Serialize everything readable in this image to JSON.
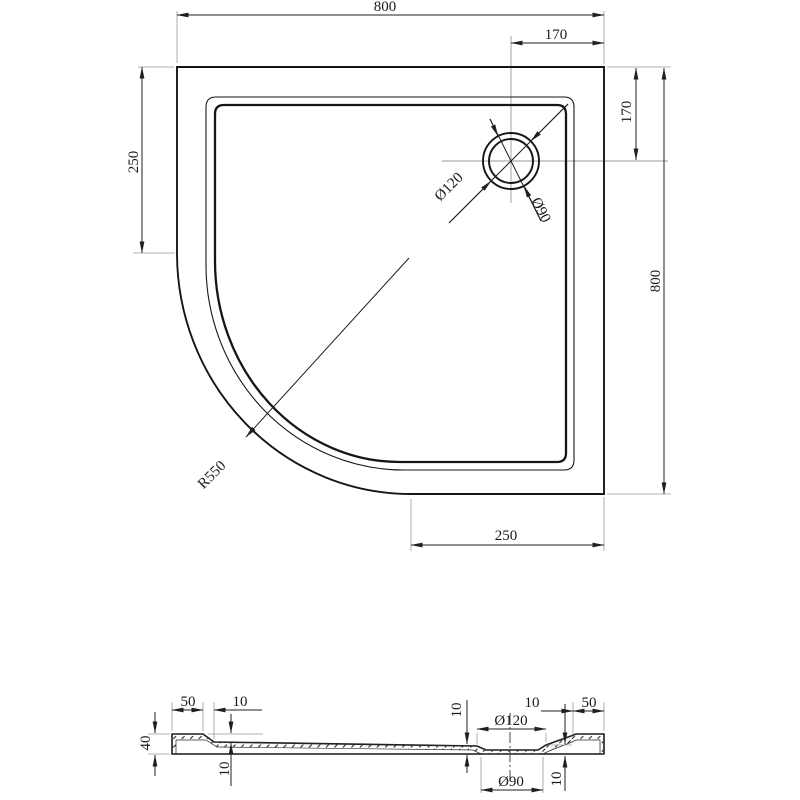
{
  "drawing": {
    "plan": {
      "width": "800",
      "height": "800",
      "drain_offset_top": "170",
      "drain_offset_right": "170",
      "left_flat": "250",
      "bottom_flat": "250",
      "corner_radius": "R550",
      "drain_outer": "Ø120",
      "drain_inner": "Ø90"
    },
    "section": {
      "left_rim": "50",
      "left_step": "10",
      "height": "40",
      "left_depth": "10",
      "mid_depth": "10",
      "drain_top": "Ø120",
      "drain_bottom": "Ø90",
      "right_step": "10",
      "right_rim": "50",
      "right_depth": "10"
    }
  }
}
